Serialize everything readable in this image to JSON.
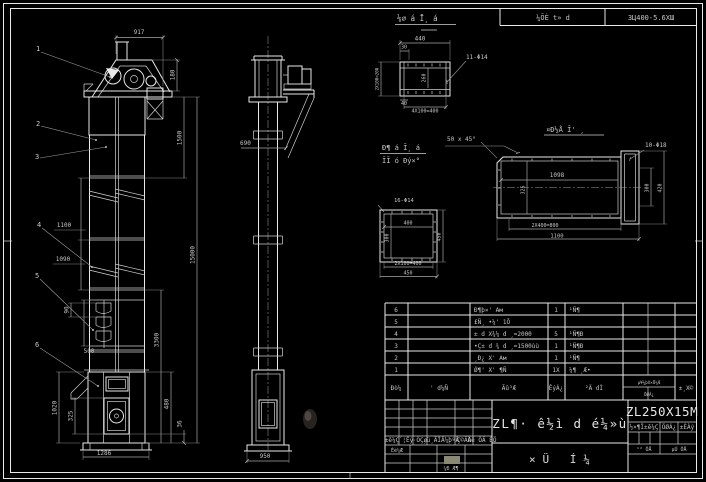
{
  "header": {
    "view_label": "⅛∅ á Ī¸ á",
    "cell_mid": "¼ÕÈ t» d",
    "cell_right": "3Ц400-5.6ХШ"
  },
  "balloons": {
    "b1": "1",
    "b2": "2",
    "b3": "3",
    "b4": "4",
    "b5": "5",
    "b6": "6"
  },
  "front": {
    "d917": "917",
    "d180": "180",
    "d1500": "1500",
    "d15000": "15000",
    "d1100": "1100",
    "d1090": "1090",
    "d90": "90",
    "d500": "500",
    "d1020": "1020",
    "d325": "325",
    "d1286": "1286",
    "d3300": "3300",
    "d480": "480",
    "d36": "36"
  },
  "side": {
    "d690": "690",
    "d950": "950"
  },
  "flange_detail": {
    "label": "11-Φ14",
    "d440": "440",
    "d30": "30",
    "dleft": "2X100=200",
    "d260": "260",
    "d40": "40",
    "dbottom": "4X100=400"
  },
  "square_detail": {
    "caption1": "Ð¶ á Ī¸ á",
    "caption2": "ĪĪ ó Ðý×°",
    "label": "16-Φ14",
    "d400": "400",
    "d300": "300",
    "d450r": "450",
    "dbot1": "2X100=400",
    "dbot2": "450"
  },
  "plate_detail": {
    "caption": "¤Ð½Å Ī' ¸",
    "chamfer": "50 x 45°",
    "label": "10-Φ18",
    "d1098": "1098",
    "d325": "325",
    "d300": "300",
    "d420": "420",
    "dbot1": "2X400=800",
    "dbot2": "1100"
  },
  "bom": {
    "header": {
      "no": "Ðò¼",
      "code": "' d¼Ñ",
      "name": "Ãû³Æ",
      "qty": "ÊýÁ¿",
      "material": "²Ä dÌ",
      "weight_top": "µ¥¼þX×Ü¼Æ",
      "weight_bottom": "ÖØÁ¿",
      "remark": "±¸X©"
    },
    "rows": [
      {
        "no": "6",
        "name": "Ð¶þ×' Ам",
        "qty": "1",
        "material": "¹Ñ¶"
      },
      {
        "no": "5",
        "name": "£Ñ¸ •¼' 1Õ",
        "qty": "",
        "material": ""
      },
      {
        "no": "4",
        "name": "± d X¾¼ d ¸=2000",
        "qty": "5",
        "material": "¹Ñ¶Ð"
      },
      {
        "no": "3",
        "name": "•Ç± d ¾ d ¸=1500ùù",
        "qty": "1",
        "material": "¹Ñ¶Ð"
      },
      {
        "no": "2",
        "name": "¸Ð¿ X' Ам",
        "qty": "1",
        "material": "¹Ñ¶"
      },
      {
        "no": "1",
        "name": "Ǿ¶' X' ¶Ñ",
        "qty": "1X",
        "material": "¼¶ ¸Æ•"
      }
    ]
  },
  "titleblock": {
    "rev_header": {
      "c1": "±ê¼Ç",
      "c2": "´¦Êý",
      "c3": "·ÖÇø",
      "c4": "¸ü¸ÄÎÄ¼þºÅ",
      "c5": "Ç©Ãû",
      "c6": "Äê ÔÂ ÈÕ"
    },
    "design_label": "Éè¼Æ",
    "check_label": "¼Ð Æ¶",
    "title_main": "ZL¶· ê½ì d é¼»ù",
    "title_sub": "×Ü Í¼",
    "model": "ZL250X15M",
    "grid": {
      "h1": "½×¶Î±ê¼Ç",
      "h2": "ÖØÁ¿",
      "h3": "±ÈÀý",
      "sheets": "¹² ÕÅ",
      "sheet_no": "µÚ ÕÅ"
    }
  }
}
